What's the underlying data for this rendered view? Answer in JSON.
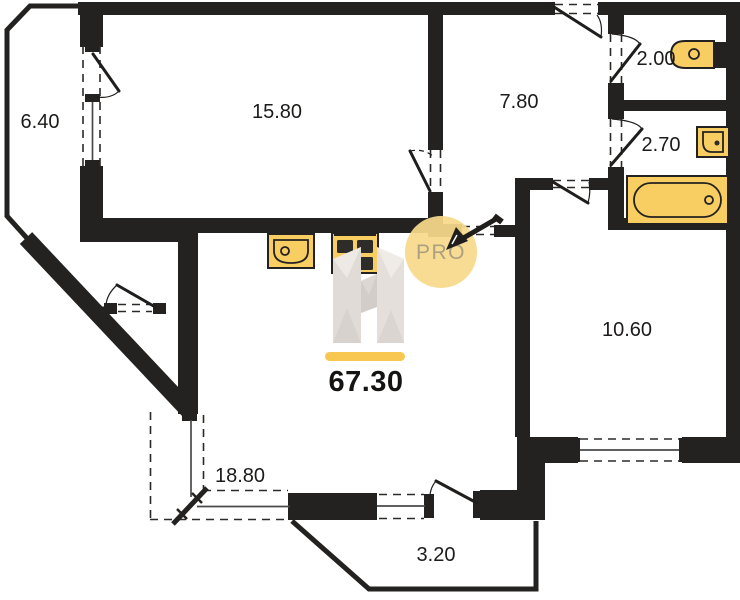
{
  "floorplan": {
    "total_area_label": "67.30",
    "watermark": {
      "brand_letter": "H",
      "badge_label": "PRO"
    },
    "rooms": {
      "balcony_left": {
        "area": "6.40"
      },
      "bedroom": {
        "area": "15.80"
      },
      "hallway": {
        "area": "7.80"
      },
      "wc": {
        "area": "2.00"
      },
      "bathroom": {
        "area": "2.70"
      },
      "room_right": {
        "area": "10.60"
      },
      "living_kitchen": {
        "area": "18.80"
      },
      "balcony_bottom": {
        "area": "3.20"
      }
    },
    "colors": {
      "wall": "#232220",
      "fixture_yellow": "#F8CD62",
      "accent_bar": "#F7C750",
      "badge_fill": "#F8D98B",
      "badge_text": "#ACA081",
      "watermark_gray": "#E0DBD6"
    }
  }
}
